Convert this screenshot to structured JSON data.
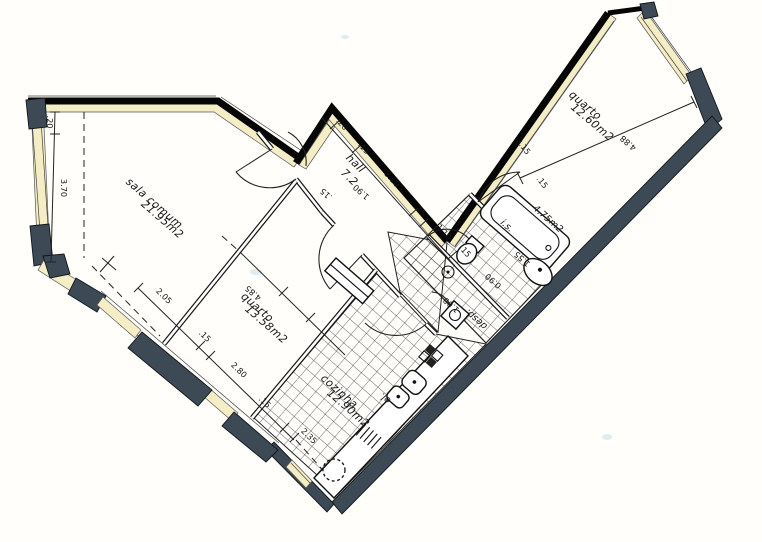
{
  "plan": {
    "title_note": "apartment floor plan (scanned blueprint)",
    "rooms": {
      "sala_name": "sala comum",
      "sala_area": "21.95m2",
      "quarto1_name": "quarto",
      "quarto1_area": "13.58m2",
      "quarto2_name": "quarto",
      "quarto2_area": "12.60m2",
      "cozinha_name": "cozinha",
      "cozinha_area": "12.90m2",
      "hall_name": "hall",
      "hall_area": "7.2",
      "is_name": "i.s.",
      "is_area": "4.75m2",
      "desp_name": "desp.",
      "el_name": "el."
    },
    "dimensions": {
      "left_offset": ".20",
      "left_width": "3.70",
      "sala_front": "2.05",
      "wall_a": ".15",
      "quarto1_front": "2.80",
      "wall_b": ".15",
      "cozinha_front": "2.35",
      "hall_offset": ".20",
      "hall_wall_a": ".15",
      "hall_front": "3.00",
      "hall_wall_b": ".15",
      "corridor_width": "1.10",
      "corridor_wall": ".15",
      "hall_depth": "1.90",
      "hall_side": ".15",
      "quarto2_front": "3.15",
      "quarto2_wall": ".15",
      "quarto2_depth": "4.88",
      "quarto1_depth": "4.85",
      "desp_width": "1.00",
      "is_width": "1.55",
      "is_depth": "0.90"
    },
    "colors": {
      "wall_fill": "#3d4a55",
      "boundary": "#060606",
      "highlight": "#f4edc6",
      "ink": "#161616",
      "paper": "#fffefb"
    }
  }
}
